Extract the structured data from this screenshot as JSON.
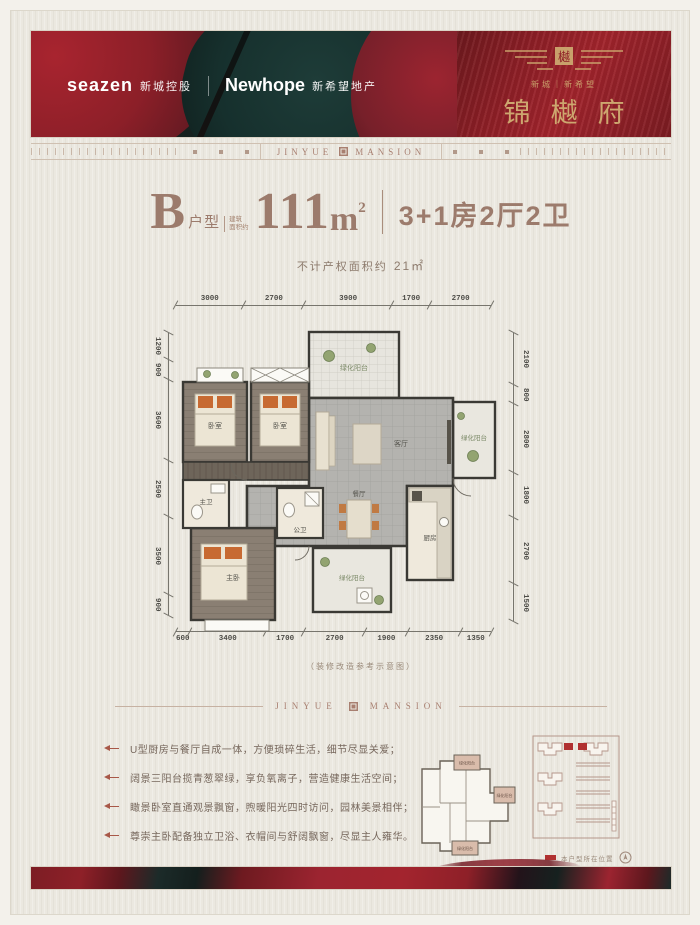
{
  "header": {
    "seazen_en": "seazen",
    "seazen_cn": "新城控股",
    "newhope_en": "Newhope",
    "newhope_cn": "新希望地产",
    "brand_small": "新城｜新希望",
    "brand_name": "锦樾府"
  },
  "ribbon": {
    "center_left": "JINYUE",
    "center_right": "MANSION"
  },
  "title": {
    "type_letter": "B",
    "type_word": "户型",
    "area_note_line1": "建筑",
    "area_note_line2": "面积约",
    "area_value": "111",
    "area_unit": "m",
    "area_sup": "2",
    "rooms_text": "3+1房2厅2卫",
    "subtitle_label": "不计产权面积约",
    "subtitle_value": "21㎡"
  },
  "floorplan": {
    "dims_top": [
      "3000",
      "2700",
      "3900",
      "1700",
      "2700"
    ],
    "dims_left": [
      "1200",
      "900",
      "3600",
      "2500",
      "3500",
      "900"
    ],
    "dims_right": [
      "2100",
      "800",
      "2800",
      "1800",
      "2700",
      "1500"
    ],
    "dims_bottom": [
      "600",
      "3400",
      "1700",
      "2700",
      "1900",
      "2350",
      "1350"
    ],
    "caption": "（装修改造参考示意图）",
    "rooms": {
      "balcony_top": "绿化阳台",
      "bedroom_left": "卧室",
      "bedroom_mid": "卧室",
      "living": "客厅",
      "balcony_right": "绿化阳台",
      "bath_master": "主卫",
      "bath_public": "公卫",
      "dining": "餐厅",
      "kitchen": "厨房",
      "master_bedroom": "主卧",
      "balcony_bottom": "绿化阳台"
    }
  },
  "divider": {
    "left": "JINYUE",
    "right": "MANSION"
  },
  "features": [
    "U型厨房与餐厅自成一体，方便琐碎生活，细节尽显关爱；",
    "阔景三阳台揽青葱翠绿，享负氧离子，营造健康生活空间；",
    "瞰景卧室直通观景飘窗，煦暖阳光四时访问，园林美景相伴；",
    "尊崇主卧配备独立卫浴、衣帽间与舒阔飘窗，尽显主人雍华。"
  ],
  "minimap": {
    "balcony": "绿化阳台",
    "legend": "本户型所在位置"
  }
}
